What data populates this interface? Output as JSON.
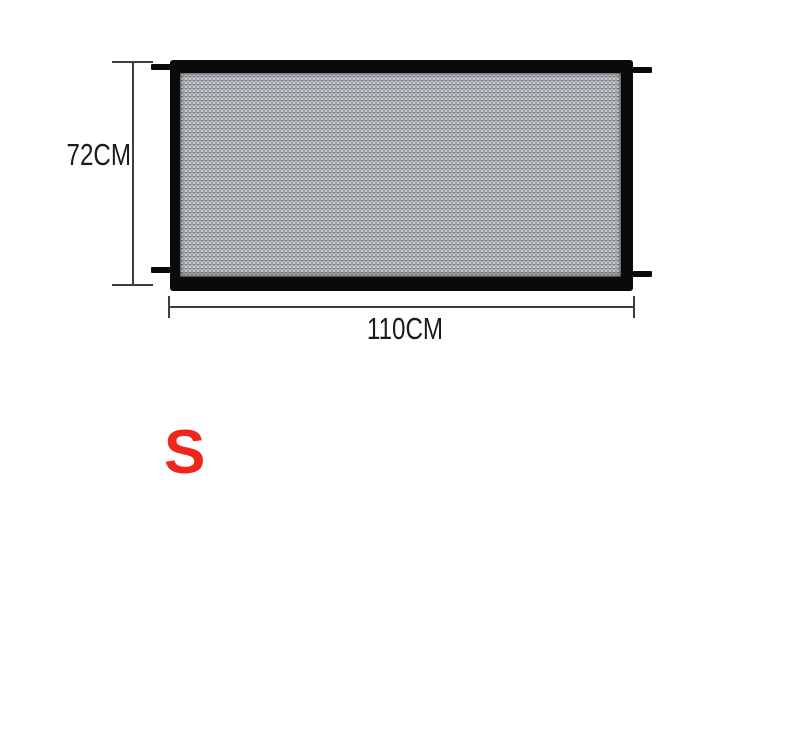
{
  "diagram": {
    "height_label": "72CM",
    "width_label": "110CM",
    "size_label": "S"
  },
  "colors": {
    "background": "#ffffff",
    "frame": "#0a0a0a",
    "mesh_base": "#a0a5ab",
    "dimension_line": "#3c4045",
    "dimension_text": "#1b1b1b",
    "size_text": "#ee261c"
  }
}
